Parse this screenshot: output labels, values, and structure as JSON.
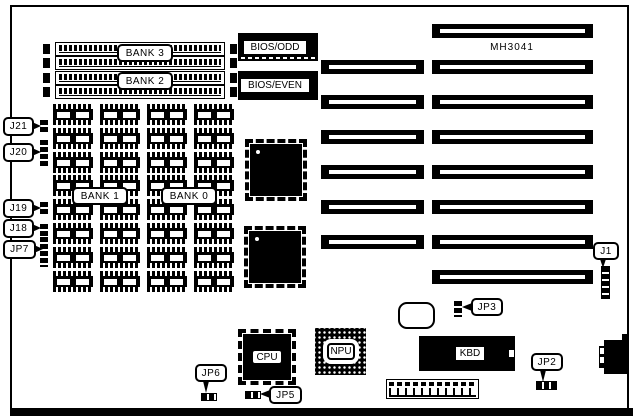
{
  "board": {
    "model": "MH3041"
  },
  "colors": {
    "ink": "#000000",
    "paper": "#ffffff"
  },
  "memory": {
    "bank3": "BANK 3",
    "bank2": "BANK 2",
    "bank1": "BANK 1",
    "bank0": "BANK 0",
    "simm_slot_count": 4,
    "dip_grid": {
      "cols": 4,
      "rows": 8
    }
  },
  "bios": {
    "odd": "BIOS/ODD",
    "even": "BIOS/EVEN"
  },
  "chips": {
    "cpu": "CPU",
    "npu": "NPU",
    "kbd": "KBD"
  },
  "expansion_slots": {
    "rows": [
      {
        "left": false,
        "right": true
      },
      {
        "left": true,
        "right": true
      },
      {
        "left": true,
        "right": true
      },
      {
        "left": true,
        "right": true
      },
      {
        "left": true,
        "right": true
      },
      {
        "left": true,
        "right": true
      },
      {
        "left": true,
        "right": true
      },
      {
        "left": false,
        "right": true
      }
    ]
  },
  "jumpers": {
    "j21": "J21",
    "j20": "J20",
    "j19": "J19",
    "j18": "J18",
    "jp7": "JP7",
    "j1": "J1",
    "jp2": "JP2",
    "jp3": "JP3",
    "jp5": "JP5",
    "jp6": "JP6"
  }
}
